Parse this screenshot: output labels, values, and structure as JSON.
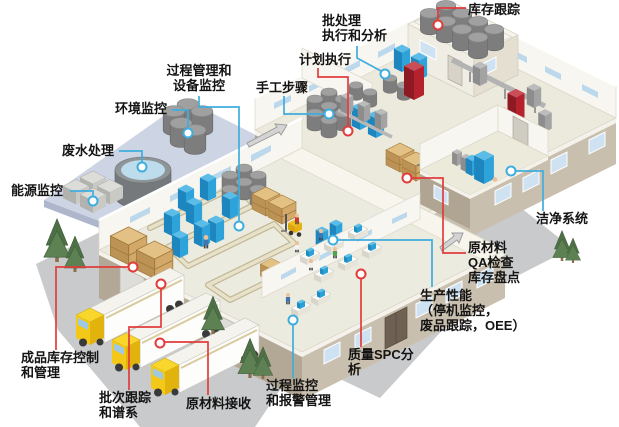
{
  "diagram_title": "MES 工厂功能示意图",
  "colors": {
    "red_leader": "#e13c3c",
    "cyan_leader": "#3fadde",
    "label_text": "#141414",
    "background": "#ffffff"
  },
  "callouts": {
    "inventory_tracking": {
      "text": "库存跟踪"
    },
    "batch_execution": {
      "text": "批处理\n执行和分析"
    },
    "plan_execution": {
      "text": "计划执行"
    },
    "manual_steps": {
      "text": "手工步骤"
    },
    "process_equipment": {
      "text": "过程管理和\n设备监控"
    },
    "environment": {
      "text": "环境监控"
    },
    "wastewater": {
      "text": "废水处理"
    },
    "energy": {
      "text": "能源监控"
    },
    "clean_system": {
      "text": "洁净系统"
    },
    "raw_material_qa": {
      "text": "原材料\nQA检查\n库存盘点"
    },
    "production_performance": {
      "text": "生产性能\n（停机监控，\n废品跟踪，OEE）"
    },
    "quality_spc": {
      "text": "质量SPC分\n析"
    },
    "process_alarm": {
      "text": "过程监控\n和报警管理"
    },
    "raw_material_receiving": {
      "text": "原材料接收"
    },
    "batch_tracking": {
      "text": "批次跟踪\n和谱系"
    },
    "finished_goods": {
      "text": "成品库存控制\n和管理"
    }
  }
}
